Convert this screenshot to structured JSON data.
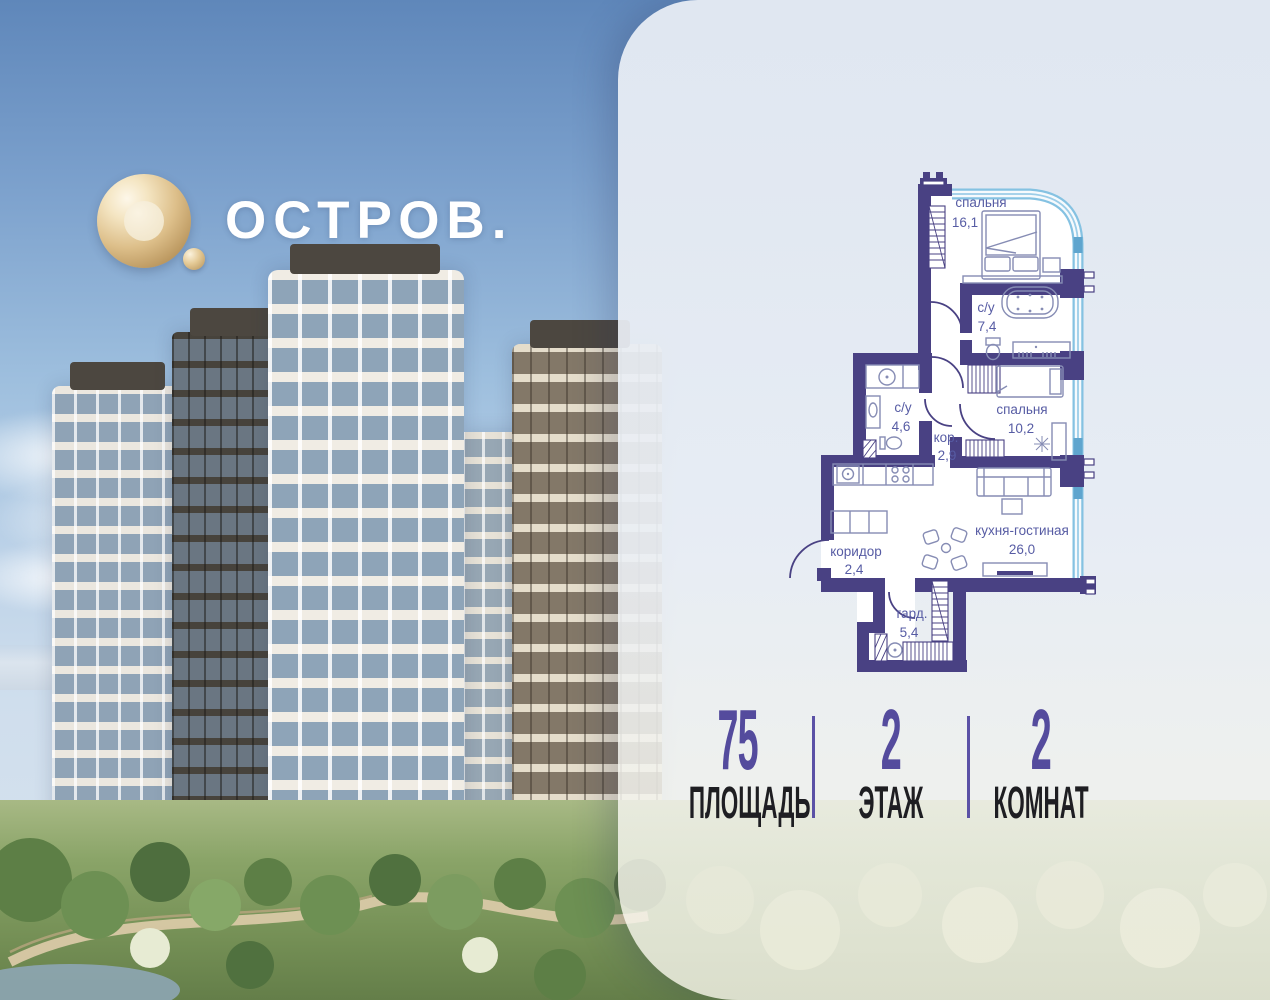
{
  "brand": {
    "name": "ОСТРОВ.",
    "logo_gold": "#D9BA84",
    "text_color": "#FFFFFF"
  },
  "floor_plan": {
    "wall_color": "#494183",
    "glazing_color": "#85C2E2",
    "label_color": "#575CA4",
    "rooms": [
      {
        "name": "спальня",
        "area": "16,1"
      },
      {
        "name": "с/у",
        "area": "7,4"
      },
      {
        "name": "с/у",
        "area": "4,6"
      },
      {
        "name": "кор.",
        "area": "2,9"
      },
      {
        "name": "спальня",
        "area": "10,2"
      },
      {
        "name": "кухня-гостиная",
        "area": "26,0"
      },
      {
        "name": "коридор",
        "area": "2,4"
      },
      {
        "name": "гард.",
        "area": "5,4"
      }
    ]
  },
  "stats": [
    {
      "value": "75",
      "label": "ПЛОЩАДЬ"
    },
    {
      "value": "2",
      "label": "ЭТАЖ"
    },
    {
      "value": "2",
      "label": "КОМНАТ"
    }
  ],
  "accent_color": "#544B9D"
}
